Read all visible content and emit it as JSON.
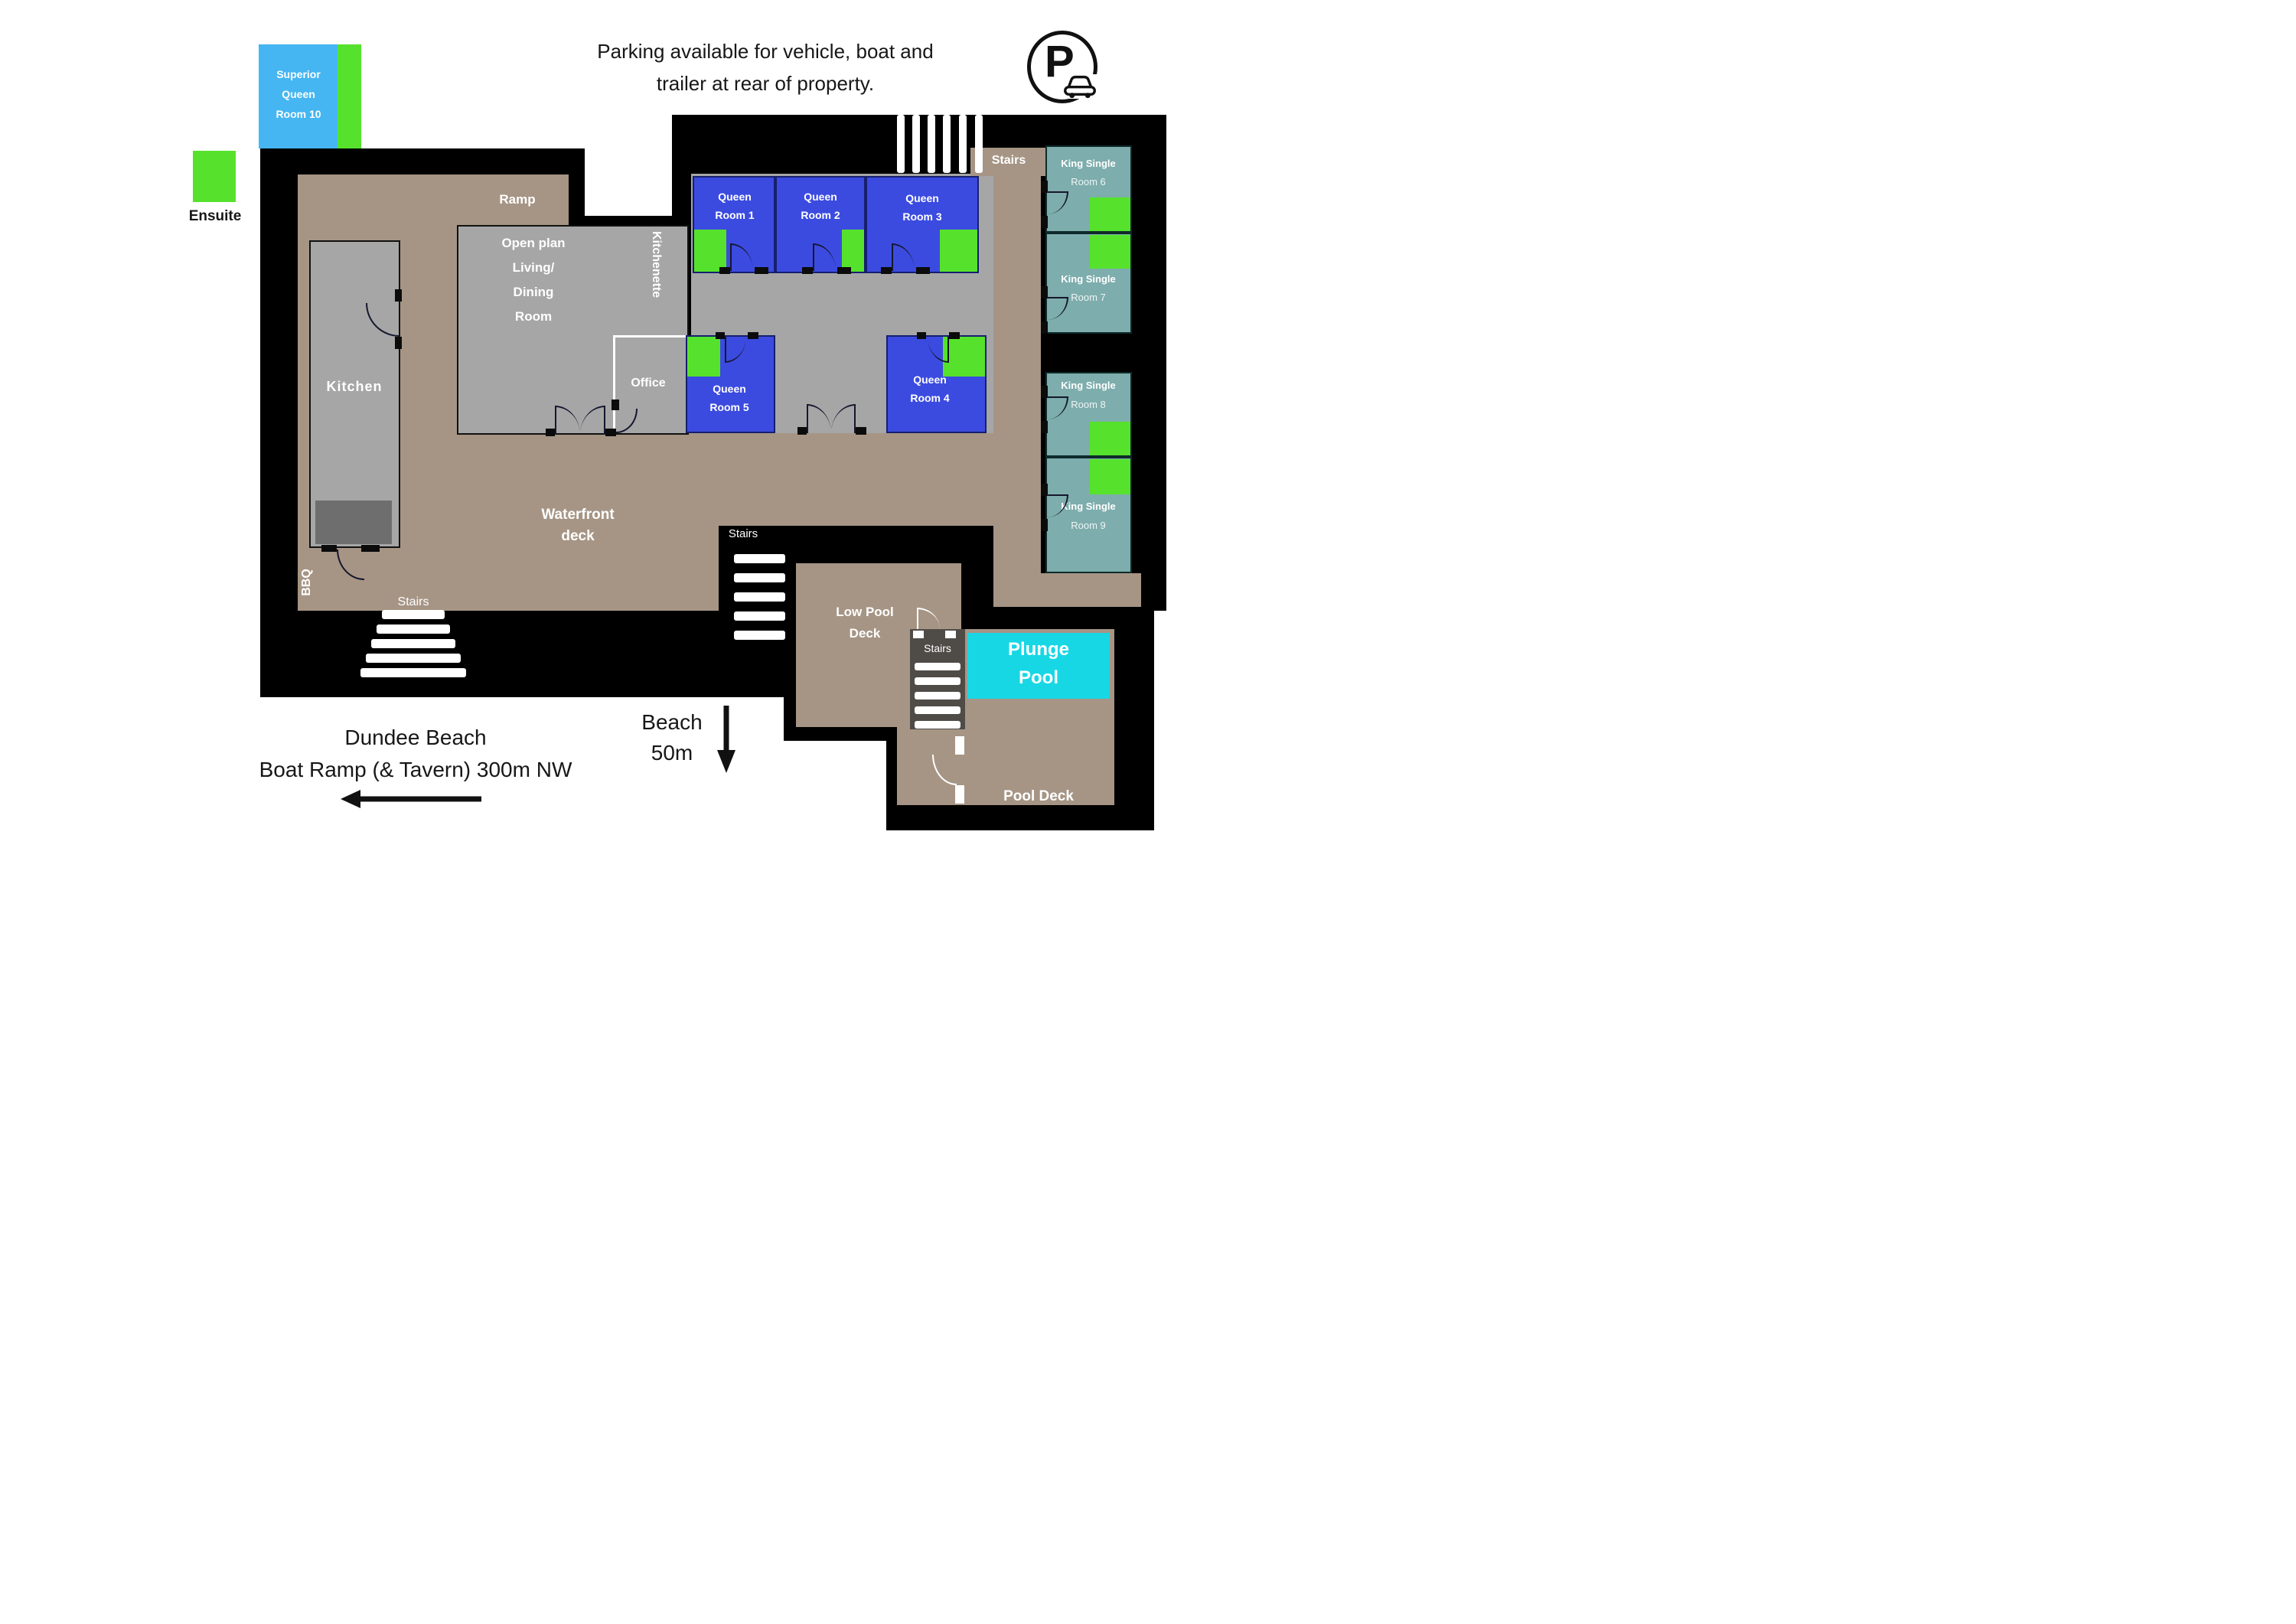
{
  "note": {
    "line1": "Parking available for vehicle, boat and",
    "line2": "trailer at rear of property."
  },
  "parking_badge": {
    "letter": "P"
  },
  "legend": {
    "label": "Ensuite",
    "swatch_color": "#56e22c"
  },
  "superior_room": {
    "line1": "Superior",
    "line2": "Queen",
    "line3": "Room 10"
  },
  "queen_rooms": [
    {
      "line1": "Queen",
      "line2": "Room 1"
    },
    {
      "line1": "Queen",
      "line2": "Room 2"
    },
    {
      "line1": "Queen",
      "line2": "Room 3"
    },
    {
      "line1": "Queen",
      "line2": "Room 4"
    },
    {
      "line1": "Queen",
      "line2": "Room 5"
    }
  ],
  "king_rooms": [
    {
      "line1": "King Single",
      "line2": "Room 6"
    },
    {
      "line1": "King Single",
      "line2": "Room 7"
    },
    {
      "line1": "King Single",
      "line2": "Room 8"
    },
    {
      "line1": "King Single",
      "line2": "Room 9"
    }
  ],
  "areas": {
    "ramp": "Ramp",
    "kitchen": "Kitchen",
    "open_plan": {
      "line1": "Open plan",
      "line2": "Living/",
      "line3": "Dining",
      "line4": "Room"
    },
    "kitchenette": "Kitchenette",
    "office": "Office",
    "bbq": "BBQ",
    "waterfront": {
      "line1": "Waterfront",
      "line2": "deck"
    },
    "stairs": "Stairs",
    "low_pool_deck": {
      "line1": "Low Pool",
      "line2": "Deck"
    },
    "plunge_pool": {
      "line1": "Plunge",
      "line2": "Pool"
    },
    "pool_deck": "Pool Deck"
  },
  "directions": {
    "boat_ramp": {
      "line1": "Dundee Beach",
      "line2": "Boat Ramp (& Tavern) 300m NW"
    },
    "beach": {
      "line1": "Beach",
      "line2": "50m"
    }
  },
  "colors": {
    "queen_blue": "#3b4be0",
    "superior_blue": "#45b6f2",
    "ensuite_green": "#56e22c",
    "king_teal": "#7dadac",
    "deck_tan": "#a69585",
    "room_gray": "#a6a6a6",
    "bench_gray": "#6e6e6e",
    "pool_cyan": "#18d7e5",
    "stair_strip_gray": "#4f4b47",
    "platform_black": "#000000"
  }
}
